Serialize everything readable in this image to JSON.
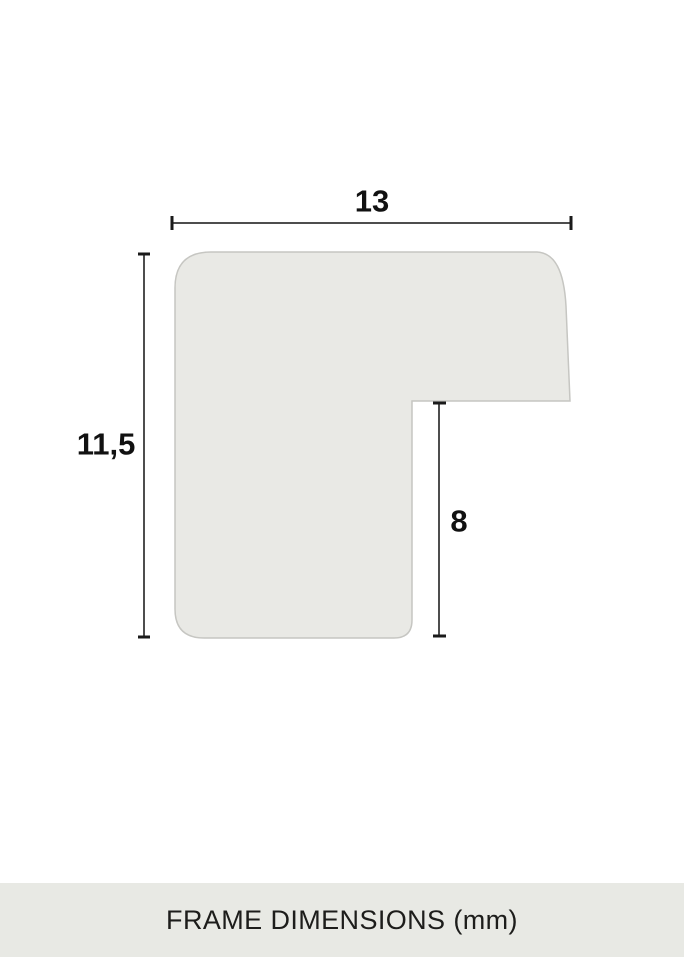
{
  "diagram": {
    "title": "Frame moulding cross-section profile",
    "dimensions": {
      "width": {
        "value": "13",
        "unit": "mm",
        "measures": "overall profile width"
      },
      "height": {
        "value": "11,5",
        "unit": "mm",
        "measures": "overall profile height"
      },
      "rabbet_height": {
        "value": "8",
        "unit": "mm",
        "measures": "height from rabbet shelf to bottom of profile"
      }
    },
    "colors": {
      "background": "#ffffff",
      "shape_fill": "#e9e9e5",
      "shape_stroke": "#c6c6c2",
      "dimension_line": "#4d4d4d",
      "tick": "#1a1a1a",
      "label_text": "#111111"
    }
  },
  "footer": {
    "title": "FRAME DIMENSIONS (mm)",
    "background": "#e8e9e4",
    "text_color": "#1d1d1b"
  }
}
